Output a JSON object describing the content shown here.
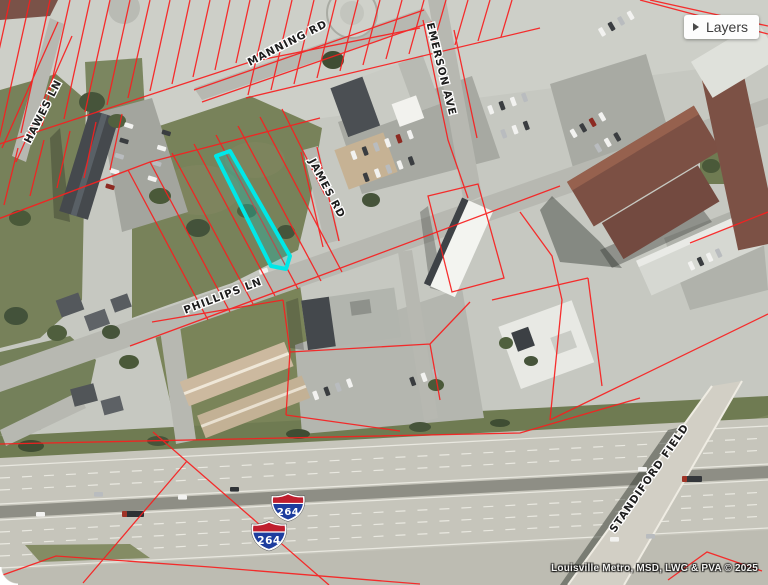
{
  "controls": {
    "layers_button": {
      "label": "Layers"
    }
  },
  "map": {
    "type": "aerial-parcel-map",
    "street_labels": [
      {
        "id": "manning-rd",
        "text": "MANNING RD"
      },
      {
        "id": "emerson-ave",
        "text": "EMERSON AVE"
      },
      {
        "id": "hawes-ln",
        "text": "HAWES LN"
      },
      {
        "id": "james-rd",
        "text": "JAMES RD"
      },
      {
        "id": "phillips-ln",
        "text": "PHILLIPS LN"
      },
      {
        "id": "standiford-field",
        "text": "STANDIFORD FIELD"
      }
    ],
    "highway_shields": [
      {
        "route": "264"
      },
      {
        "route": "264"
      }
    ],
    "selected_parcel": {
      "highlight_color": "#00e8e8"
    },
    "colors": {
      "parcel_line": "#f81f1f",
      "shield_red": "#bf1e2e",
      "shield_blue": "#1d3d9e"
    }
  },
  "attribution": {
    "text": "Louisville Metro, MSD, LWC & PVA © 2025"
  }
}
